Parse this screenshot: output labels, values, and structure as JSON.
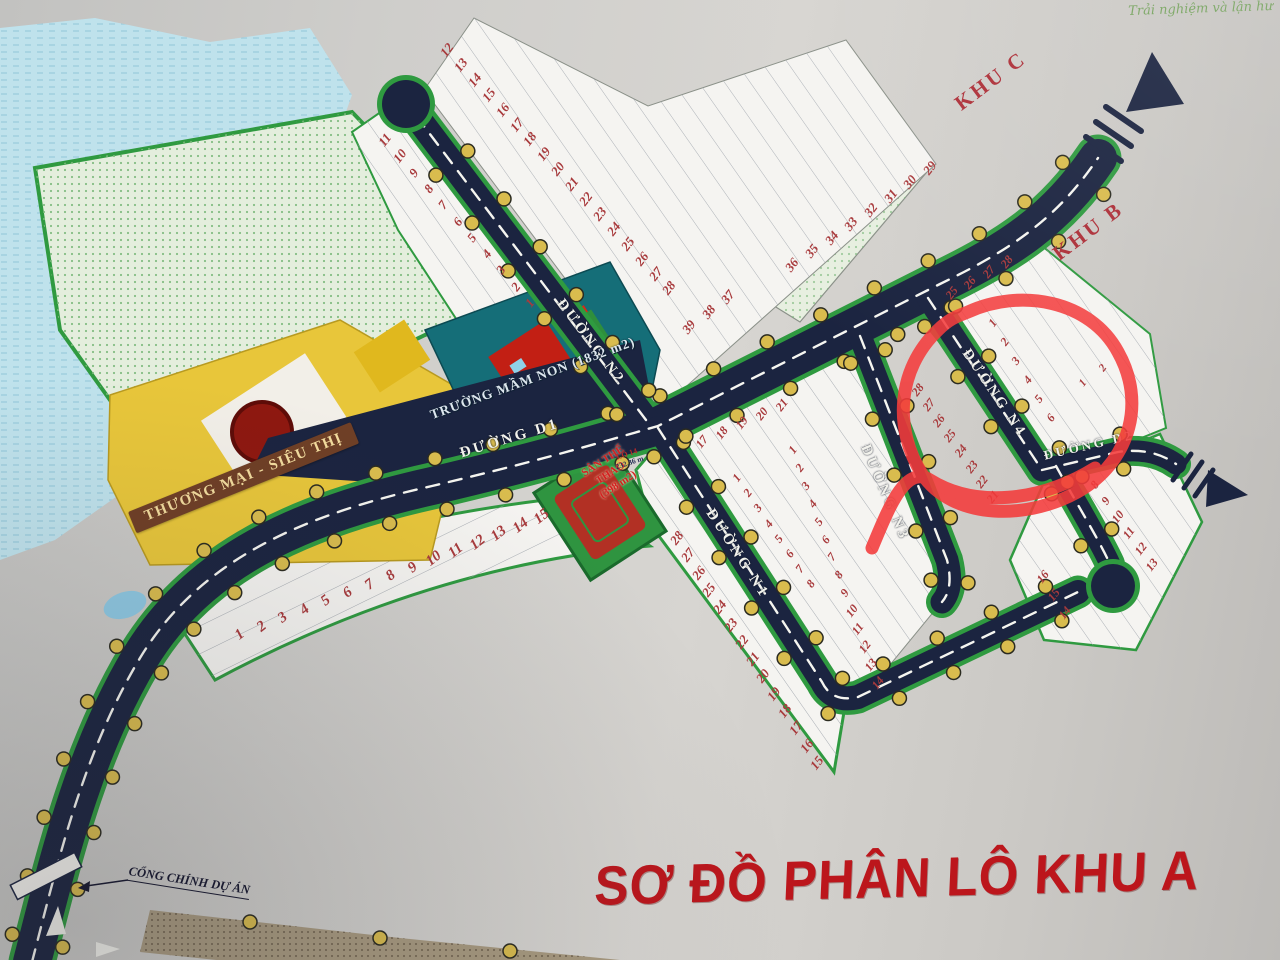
{
  "title": "SƠ ĐỒ PHÂN LÔ KHU A",
  "watermark": "Trải nghiệm và lận hư",
  "zones": {
    "khu_c": "KHU C",
    "khu_b": "KHU B",
    "kindergarten": {
      "name": "TRƯỜNG MẦM NON",
      "area": "(1832 m2)"
    },
    "commercial": "THƯƠNG MẠI - SIÊU THỊ",
    "sports": {
      "line1": "SÂN THỂ",
      "line2": "THAO",
      "area": "(398 m2)"
    },
    "gate": "CỔNG CHÍNH DỰ ÁN",
    "lot14_note": {
      "lot": "LÔ 14",
      "area": "232,36 m"
    }
  },
  "roads": [
    {
      "id": "d1",
      "label": "ĐƯỜNG D1"
    },
    {
      "id": "n1",
      "label": "ĐƯỜNG N1"
    },
    {
      "id": "n2",
      "label": "ĐƯỜNG N2"
    },
    {
      "id": "n3",
      "label": "ĐƯỜNG N3"
    },
    {
      "id": "n4",
      "label": "ĐƯỜNG N4"
    },
    {
      "id": "d2",
      "label": "ĐƯỜNG D2"
    }
  ],
  "lot_runs": [
    {
      "id": "r_n2w",
      "numbers": [
        11,
        10,
        9,
        8,
        7,
        6,
        5,
        4,
        3,
        2,
        1
      ]
    },
    {
      "id": "r_n2e",
      "numbers": [
        12,
        13,
        14,
        15,
        16,
        17,
        18,
        19,
        20,
        21,
        22,
        23,
        24,
        25,
        26,
        27,
        28
      ]
    },
    {
      "id": "r_3739",
      "numbers": [
        37,
        38,
        39
      ]
    },
    {
      "id": "r_2936",
      "numbers": [
        29,
        30,
        31,
        32,
        33,
        34,
        35,
        36
      ]
    },
    {
      "id": "r_khub",
      "numbers": [
        25,
        26,
        27,
        28
      ]
    },
    {
      "id": "r_n4e",
      "numbers": [
        1,
        2,
        3,
        4,
        5,
        6
      ]
    },
    {
      "id": "r_n4w",
      "numbers": [
        28,
        27,
        26,
        25,
        24,
        23,
        22,
        21
      ]
    },
    {
      "id": "r_d2col",
      "numbers": [
        2,
        1
      ]
    },
    {
      "id": "r_d2se",
      "numbers": [
        8,
        9,
        10,
        11,
        12,
        13
      ]
    },
    {
      "id": "r_d2sb",
      "numbers": [
        16,
        15,
        14
      ]
    },
    {
      "id": "r_midtop",
      "numbers": [
        17,
        18,
        19,
        20,
        21
      ]
    },
    {
      "id": "r_midA",
      "numbers": [
        1,
        2,
        3,
        4,
        5,
        6,
        7,
        8
      ]
    },
    {
      "id": "r_midB",
      "numbers": [
        1,
        2,
        3,
        4,
        5,
        6,
        7,
        8,
        9,
        10,
        11,
        12,
        13,
        14
      ]
    },
    {
      "id": "r_botW",
      "numbers": [
        28,
        27,
        26,
        25,
        24,
        23,
        22,
        21,
        20,
        19,
        18,
        17,
        16,
        15
      ]
    },
    {
      "id": "r_blk7",
      "numbers": [
        1,
        2,
        3,
        4,
        5,
        6,
        7,
        8,
        9,
        10,
        11,
        12,
        13,
        14,
        15
      ]
    }
  ],
  "colors": {
    "road_navy": "#1b2440",
    "boundary_green": "#2f9a40",
    "highlight_red": "#f43b3b",
    "title_red": "#bc161c",
    "lamp_yellow": "#d9bc4e",
    "water_blue": "#bfe2ec",
    "commercial_yellow": "#e8c63a",
    "kindergarten_teal": "#156e78",
    "lot_number_red": "#a83a3c"
  }
}
